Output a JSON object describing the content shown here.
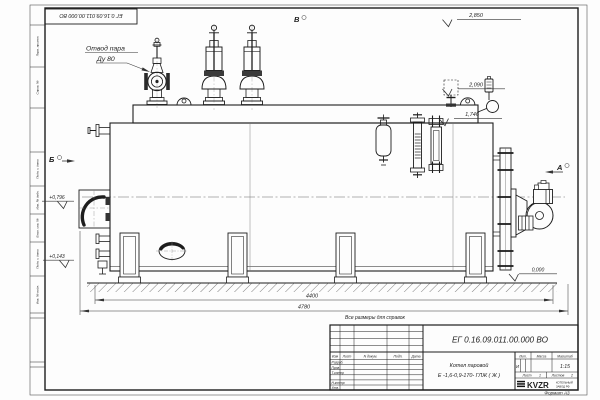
{
  "drawing": {
    "doc_number_stamp": "ЕГ 0.16.09.011.00.000  ВО",
    "callouts": {
      "steam_outlet_line1": "Отвод пара",
      "steam_outlet_line2": "Ду 80"
    },
    "note": "Все размеры для справок",
    "view_markers": {
      "top": "В",
      "left": "Б",
      "right": "А"
    },
    "elevations": {
      "valve_top": "2,850",
      "gauge_top": "2,090",
      "fitting_top": "1,746",
      "burner_axis": "+0,796",
      "lower_mark": "+0,143",
      "ground": "0,000"
    },
    "dimensions": {
      "length_supports": "4400",
      "length_overall": "4780"
    }
  },
  "frame": {
    "side_labels": [
      "Перв. примен.",
      "Справ. №",
      "Подп. и дата",
      "Инв. № дубл.",
      "Взам. инв. №",
      "Подп. и дата",
      "Инв. № подл."
    ],
    "format_note": "Формат А3"
  },
  "title_block": {
    "doc_number": "ЕГ 0.16.09.011.00.000  ВО",
    "product_line1": "Котел паровой",
    "product_line2": "Е -1,6-0,9-170- ГЛЖ ( Ж )",
    "header_cols": [
      "Изм",
      "Лист",
      "N докум.",
      "Подп.",
      "Дата"
    ],
    "staff_rows": [
      "Разраб.",
      "Пров.",
      "Т.контр",
      "Н.контр",
      "Утв."
    ],
    "lit_header": "Лит.",
    "mass_header": "Масса",
    "scale_header": "Масштаб",
    "lit_value": "И",
    "scale_value": "1:15",
    "sheet_label": "Лист",
    "sheet_value": "1",
    "sheets_label": "Листов",
    "sheets_value": "2",
    "logo_text": "KVZR",
    "logo_sub1": "КОТЕЛЬНЫЙ",
    "logo_sub2": "ЗАВОД РФ"
  }
}
